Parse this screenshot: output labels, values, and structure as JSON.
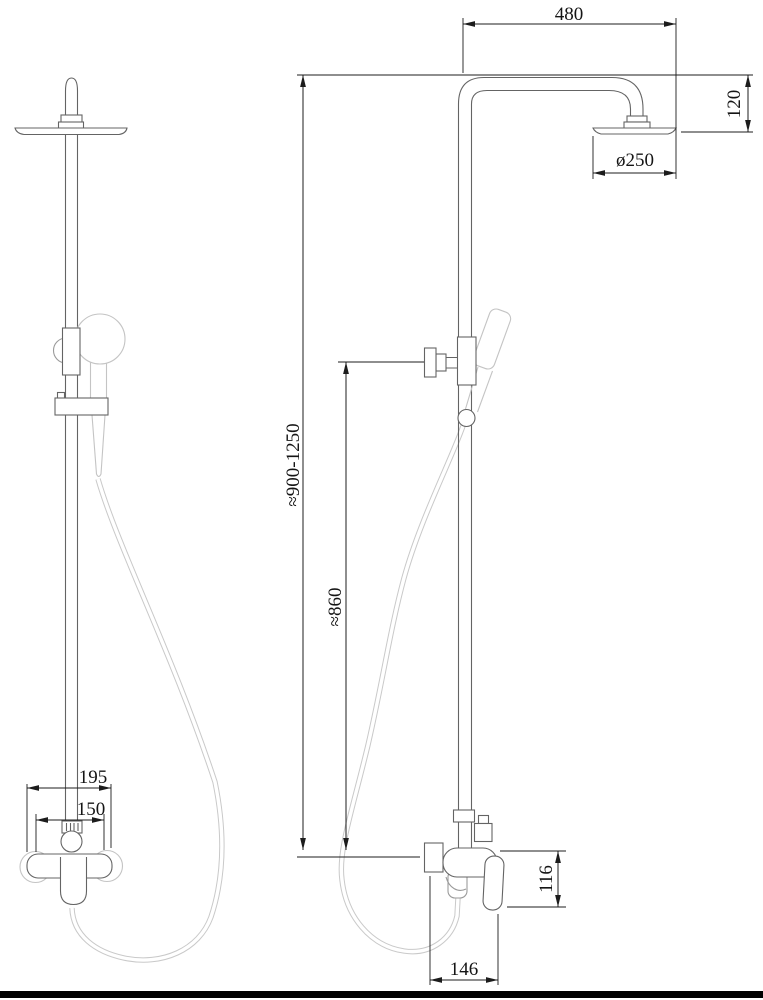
{
  "drawing": {
    "dimensions": {
      "arm_reach": "480",
      "head_drop": "120",
      "head_diameter": "ø250",
      "column_height": "≈900-1250",
      "hose_pipe_length": "≈860",
      "mixer_height": "116",
      "mixer_width_side": "146",
      "mixer_width_front": "195",
      "inlet_spacing": "150"
    },
    "colors": {
      "background": "#ffffff",
      "fixture_line": "#646464",
      "light_line": "#c4c4c4",
      "dimension_line": "#1c1c1c",
      "footer_bar": "#000000"
    }
  }
}
